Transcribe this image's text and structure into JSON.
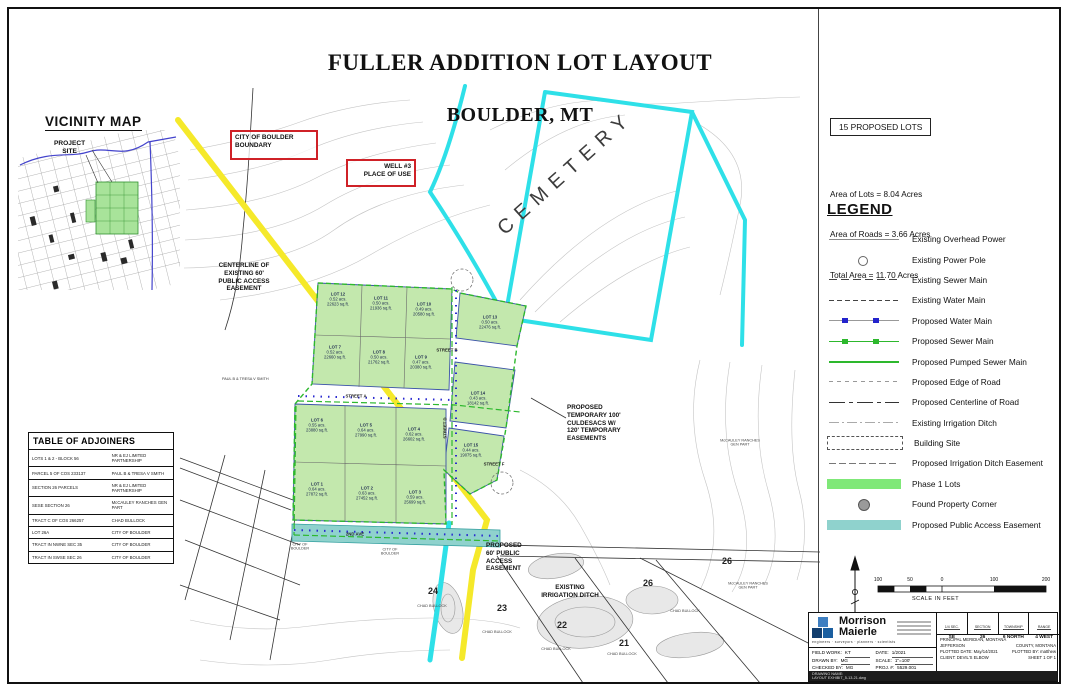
{
  "sheet": {
    "title_line1": "FULLER ADDITION LOT LAYOUT",
    "title_line2": "BOULDER, MT"
  },
  "vicinity": {
    "title": "VICINITY MAP",
    "project_site": "PROJECT\nSITE"
  },
  "summary": {
    "proposed_lots": "15 PROPOSED LOTS",
    "lines": [
      {
        "text": "Area of Lots = 8.04 Acres"
      },
      {
        "text": "Area of Roads = 3.66 Acres"
      },
      {
        "text": "Total Area = 11.70 Acres"
      }
    ]
  },
  "legend": {
    "title": "LEGEND",
    "items": [
      {
        "label": "Existing Overhead Power",
        "swatch": "sw-overhead"
      },
      {
        "label": "Existing Power Pole",
        "swatch": "sw-pole"
      },
      {
        "label": "Existing Sewer Main",
        "swatch": "sw-exsewer"
      },
      {
        "label": "Existing Water Main",
        "swatch": "sw-exwater"
      },
      {
        "label": "Proposed Water Main",
        "swatch": "sw-pwater"
      },
      {
        "label": "Proposed Sewer Main",
        "swatch": "sw-psewer"
      },
      {
        "label": "Proposed Pumped Sewer Main",
        "swatch": "sw-pumped"
      },
      {
        "label": "Proposed Edge of Road",
        "swatch": "sw-edge"
      },
      {
        "label": "Proposed Centerline of Road",
        "swatch": "sw-center"
      },
      {
        "label": "Existing Irrigation Ditch",
        "swatch": "sw-ditch"
      },
      {
        "label": "Building Site",
        "swatch": "sw-bldg"
      },
      {
        "label": "Proposed Irrigation Ditch Easement",
        "swatch": "sw-ditch-esmt"
      },
      {
        "label": "Phase 1 Lots",
        "swatch": "sw-phase1",
        "color": "#7fe878"
      },
      {
        "label": "Found Property Corner",
        "swatch": "sw-corner"
      },
      {
        "label": "Proposed Public Access Easement",
        "swatch": "sw-paccess",
        "color": "#8fd2cd"
      }
    ]
  },
  "adjoiners": {
    "title": "TABLE OF ADJOINERS",
    "rows": [
      {
        "parcel": "LOTS 1 & 2 - BLOCK 56",
        "owner": "NR & EJ LIMITED PARTNERSHIP"
      },
      {
        "parcel": "PARCEL 5 OF COS 233137",
        "owner": "PAUL B & TRESA V SMITH"
      },
      {
        "parcel": "SECTION 26 PARCELS",
        "owner": "NR & EJ LIMITED PARTNERSHIP"
      },
      {
        "parcel": "SESE SECTION 26",
        "owner": "McCAULEY RANCHES GEN PART"
      },
      {
        "parcel": "TRACT C OF COS 266257",
        "owner": "CHAD BULLOCK"
      },
      {
        "parcel": "LOT 26A",
        "owner": "CITY OF BOULDER"
      },
      {
        "parcel": "TRACT IN NWNE SEC 35",
        "owner": "CITY OF BOULDER"
      },
      {
        "parcel": "TRACT IN SWSE SEC 26",
        "owner": "CITY OF BOULDER"
      }
    ]
  },
  "map": {
    "boundary_box_label": "CITY OF BOULDER\nBOUNDARY",
    "well_box_label": "WELL #3\nPLACE OF USE",
    "cemetery": "CEMETERY",
    "centerline_label": "CENTERLINE OF\nEXISTING 60'\nPUBLIC ACCESS\nEASEMENT",
    "culdesac_label": "PROPOSED\nTEMPORARY 100'\nCULDESACS W/\n120' TEMPORARY\nEASEMENTS",
    "access_label": "PROPOSED\n60' PUBLIC\nACCESS\nEASEMENT",
    "ditch_label": "EXISTING\nIRRIGATION DITCH",
    "paul_smith": "PAUL B & TRESA V SMITH",
    "streets": [
      {
        "label": "STREET A",
        "x": 356,
        "y": 396
      },
      {
        "label": "STREET B",
        "x": 447,
        "y": 350
      },
      {
        "label": "STREET D",
        "x": 445,
        "y": 428,
        "cls": "vert"
      },
      {
        "label": "STREET F",
        "x": 494,
        "y": 464
      },
      {
        "label": "2ND AVE",
        "x": 355,
        "y": 534
      }
    ],
    "lots": [
      {
        "name": "LOT 1",
        "acres": "0.64 acs.",
        "sqft": "27872 sq.ft.",
        "x": 317,
        "y": 489
      },
      {
        "name": "LOT 2",
        "acres": "0.63 acs.",
        "sqft": "27452 sq.ft.",
        "x": 367,
        "y": 493
      },
      {
        "name": "LOT 3",
        "acres": "0.59 acs.",
        "sqft": "25699 sq.ft.",
        "x": 415,
        "y": 497
      },
      {
        "name": "LOT 4",
        "acres": "0.62 acs.",
        "sqft": "26602 sq.ft.",
        "x": 414,
        "y": 434
      },
      {
        "name": "LOT 5",
        "acres": "0.64 acs.",
        "sqft": "27990 sq.ft.",
        "x": 366,
        "y": 430
      },
      {
        "name": "LOT 6",
        "acres": "0.55 acs.",
        "sqft": "23880 sq.ft.",
        "x": 317,
        "y": 425
      },
      {
        "name": "LOT 7",
        "acres": "0.52 acs.",
        "sqft": "22660 sq.ft.",
        "x": 335,
        "y": 352
      },
      {
        "name": "LOT 8",
        "acres": "0.50 acs.",
        "sqft": "21762 sq.ft.",
        "x": 379,
        "y": 357
      },
      {
        "name": "LOT 9",
        "acres": "0.47 acs.",
        "sqft": "20380 sq.ft.",
        "x": 421,
        "y": 362
      },
      {
        "name": "LOT 10",
        "acres": "0.49 acs.",
        "sqft": "20580 sq.ft.",
        "x": 424,
        "y": 309
      },
      {
        "name": "LOT 11",
        "acres": "0.50 acs.",
        "sqft": "21936 sq.ft.",
        "x": 381,
        "y": 303
      },
      {
        "name": "LOT 12",
        "acres": "0.52 acs.",
        "sqft": "22623 sq.ft.",
        "x": 338,
        "y": 299
      },
      {
        "name": "LOT 13",
        "acres": "0.50 acs.",
        "sqft": "22476 sq.ft.",
        "x": 490,
        "y": 322
      },
      {
        "name": "LOT 14",
        "acres": "0.43 acs.",
        "sqft": "18142 sq.ft.",
        "x": 478,
        "y": 398
      },
      {
        "name": "LOT 15",
        "acres": "0.44 acs.",
        "sqft": "19075 sq.ft.",
        "x": 471,
        "y": 450
      }
    ],
    "parcels": [
      {
        "num": "24",
        "x": 433,
        "y": 591
      },
      {
        "num": "23",
        "x": 502,
        "y": 608
      },
      {
        "num": "22",
        "x": 562,
        "y": 625
      },
      {
        "num": "21",
        "x": 624,
        "y": 643
      },
      {
        "num": "26",
        "x": 648,
        "y": 583
      },
      {
        "num": "26",
        "x": 727,
        "y": 561
      }
    ],
    "owners": [
      {
        "label": "CHAD BULLOCK",
        "x": 432,
        "y": 606
      },
      {
        "label": "CHAD BULLOCK",
        "x": 497,
        "y": 632
      },
      {
        "label": "CHAD BULLOCK",
        "x": 556,
        "y": 649
      },
      {
        "label": "CHAD BULLOCK",
        "x": 622,
        "y": 654
      },
      {
        "label": "CHAD BULLOCK",
        "x": 685,
        "y": 611
      },
      {
        "label": "McCAULEY RANCHES\nGEN PART",
        "x": 740,
        "y": 443
      },
      {
        "label": "McCAULEY RANCHES\nGEN PART",
        "x": 748,
        "y": 586
      },
      {
        "label": "CITY OF\nBOULDER",
        "x": 300,
        "y": 547
      },
      {
        "label": "CITY OF\nBOULDER",
        "x": 390,
        "y": 552
      }
    ]
  },
  "scale_bar": {
    "label": "SCALE IN FEET",
    "ticks": [
      {
        "t": "100",
        "x": 878
      },
      {
        "t": "50",
        "x": 910
      },
      {
        "t": "0",
        "x": 942
      },
      {
        "t": "100",
        "x": 994
      },
      {
        "t": "200",
        "x": 1046
      }
    ]
  },
  "title_block": {
    "company_line1": "Morrison",
    "company_line2": "Maierle",
    "tagline": "engineers · surveyors · planners · scientists",
    "fields": [
      {
        "label": "FIELD WORK:",
        "value": "KT"
      },
      {
        "label": "DRAWN BY:",
        "value": "MG"
      },
      {
        "label": "CHECKED BY:",
        "value": "MG"
      },
      {
        "label": "DATE:",
        "value": "1/2021"
      },
      {
        "label": "SCALE:",
        "value": "1\"=100'"
      },
      {
        "label": "PROJ. #:",
        "value": "5529.001"
      }
    ],
    "sections": [
      {
        "label": "1/4 SEC.",
        "value": "SE"
      },
      {
        "label": "SECTION",
        "value": "26"
      },
      {
        "label": "TOWNSHIP",
        "value": "6 NORTH"
      },
      {
        "label": "RANGE",
        "value": "4 WEST"
      }
    ],
    "meridian": "PRINCIPAL MERIDIAN, MONTANA",
    "county_left": "JEFFERSON",
    "county_right": "COUNTY, MONTANA",
    "plotted_date": "PLOTTED DATE: May/14/2021",
    "plotted_by": "PLOTTED BY: matthew",
    "client": "CLIENT: DEVIL'S ELBOW",
    "sheet": "SHEET  1  OF  1",
    "drawing_name": "DRAWING NAME:\nLAYOUT EXHIBIT_5-13-21.dwg"
  }
}
